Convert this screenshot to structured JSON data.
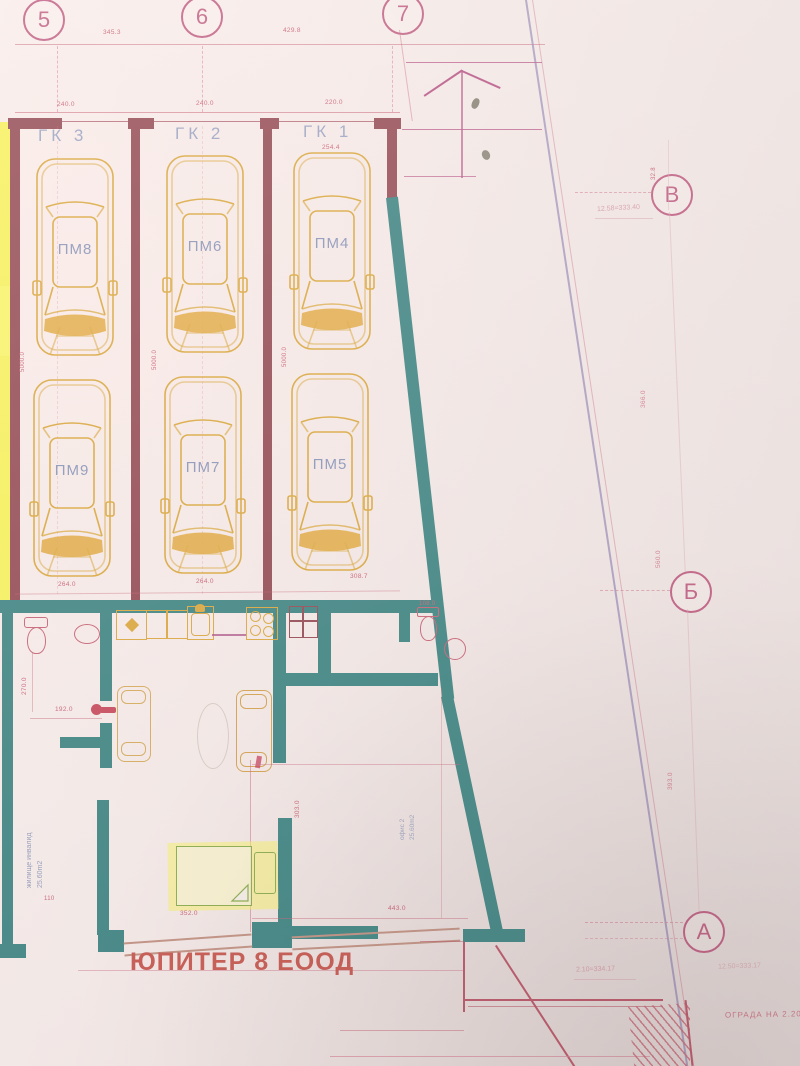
{
  "axes": {
    "top": [
      "5",
      "6",
      "7"
    ],
    "right": [
      "В",
      "Б",
      "А"
    ]
  },
  "dims": {
    "span_5_6": "345.3",
    "span_6_7": "429.8",
    "garage_w1": "240.0",
    "garage_w2": "240.0",
    "garage_w3": "220.0",
    "gk1_inner": "254.4",
    "stall_depth": "5000.0",
    "stall_b1": "264.0",
    "stall_b2": "264.0",
    "stall_b3": "308.7",
    "bath_h": "270.0",
    "bath_w": "192.0",
    "wc_w": "108.0",
    "bed_small": "110",
    "bed_w": "352.0",
    "office_w": "443.0",
    "office_h": "303.0",
    "right_1": "32.8",
    "right_2": "366.0",
    "right_3": "560.0",
    "right_4": "393.0"
  },
  "garages": [
    {
      "label": "ГК 3"
    },
    {
      "label": "ГК 2"
    },
    {
      "label": "ГК 1"
    }
  ],
  "parking_spots": [
    {
      "label": "ПМ8"
    },
    {
      "label": "ПМ6"
    },
    {
      "label": "ПМ4"
    },
    {
      "label": "ПМ9"
    },
    {
      "label": "ПМ7"
    },
    {
      "label": "ПМ5"
    }
  ],
  "rooms": [
    {
      "name": "жилище инвалид",
      "area": "25.60m2"
    },
    {
      "name": "офис 2",
      "area": "25.60m2"
    }
  ],
  "notes": {
    "level_b": "12.58=333.40",
    "level_a1": "2.10=334.17",
    "level_a2": "12.50=333.17",
    "fence": "ОГРАДА НА 2.20",
    "watermark": "ЮПИТЕР 8 ЕООД"
  },
  "colors": {
    "paper": "#f3e9e6",
    "wall_teal": "#2e7b79",
    "wall_maroon": "#8b3c46",
    "line_red": "#c4556b",
    "car_orange": "#d7a12e",
    "highlight_yellow": "#f6f23d",
    "label_blue": "#8591b6",
    "watermark_red": "#c14a41"
  }
}
